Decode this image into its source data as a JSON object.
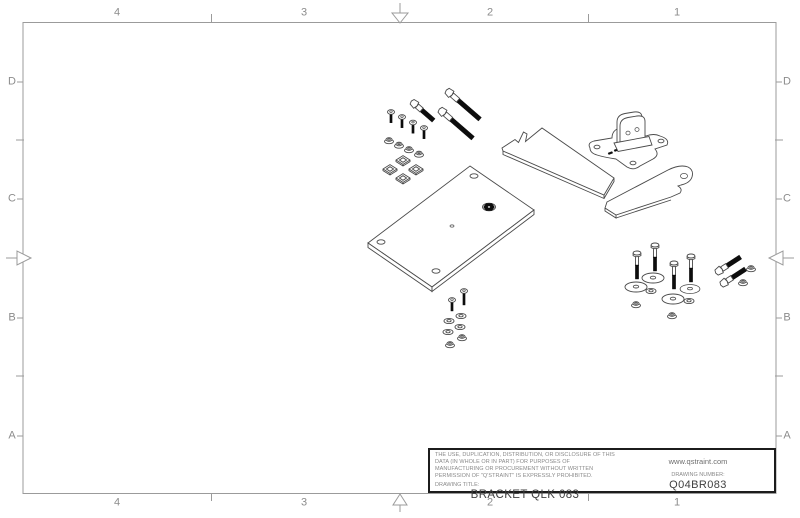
{
  "colors": {
    "frame": "#9b9b9b",
    "label": "#8c8c8c",
    "line": "#4a4a4a",
    "dark": "#0d0d0d",
    "tb_border": "#1c1c1c",
    "tb_text": "#3f3f3f",
    "tb_muted": "#8a8a8a"
  },
  "frame": {
    "zones": {
      "cols": [
        "4",
        "3",
        "2",
        "1"
      ],
      "rows": [
        "D",
        "C",
        "B",
        "A"
      ]
    }
  },
  "title_block": {
    "legal": "THE USE, DUPLICATION, DISTRIBUTION, OR DISCLOSURE OF THIS DATA (IN WHOLE OR IN PART) FOR PURPOSES OF MANUFACTURING OR PROCUREMENT WITHOUT WRITTEN PERMISSION OF \"Q'STRAINT\" IS EXPRESSLY PROHIBITED.",
    "website": "www.qstraint.com",
    "drawing_title_label": "DRAWING TITLE:",
    "drawing_title": "BRACKET QLK 083",
    "drawing_number_label": "DRAWING NUMBER:",
    "drawing_number": "Q04BR083"
  }
}
